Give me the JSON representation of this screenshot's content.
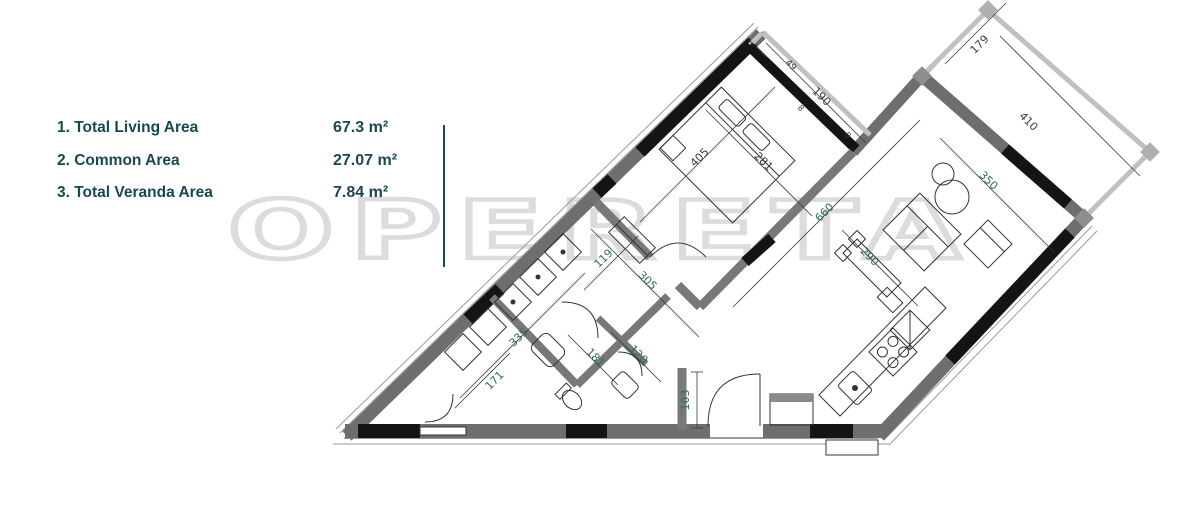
{
  "legend": {
    "items": [
      {
        "label": "1. Total Living Area",
        "value": "67.3 m²"
      },
      {
        "label": "2. Common Area",
        "value": "27.07 m²"
      },
      {
        "label": "3. Total Veranda Area",
        "value": "7.84 m²"
      }
    ]
  },
  "watermark": {
    "text": "OPERETA"
  },
  "colors": {
    "legend_teal": "#17494f",
    "dimension_teal": "#2e6b5e",
    "dimension_dark": "#3c3c3c",
    "wall_gray": "#6e6e6e",
    "wall_black": "#141414",
    "parapet_gray": "#c0c0c0",
    "watermark_gray": "#dcdcdc"
  },
  "floorplan": {
    "dimension_labels": [
      {
        "text": "405",
        "x": 702,
        "y": 160,
        "rot": -45,
        "color": "#3c3c3c"
      },
      {
        "text": "281",
        "x": 761,
        "y": 164,
        "rot": 45,
        "color": "#3c3c3c"
      },
      {
        "text": "190",
        "x": 819,
        "y": 99,
        "rot": 45,
        "color": "#3c3c3c"
      },
      {
        "text": "49",
        "x": 789,
        "y": 67,
        "rot": 45,
        "color": "#3c3c3c",
        "size": 9
      },
      {
        "text": "8",
        "x": 799,
        "y": 110,
        "rot": 45,
        "color": "#3c3c3c",
        "size": 8
      },
      {
        "text": "8",
        "x": 846,
        "y": 137,
        "rot": 45,
        "color": "#3c3c3c",
        "size": 8
      },
      {
        "text": "179",
        "x": 982,
        "y": 47,
        "rot": -45,
        "color": "#3c3c3c"
      },
      {
        "text": "410",
        "x": 1026,
        "y": 124,
        "rot": 45,
        "color": "#3c3c3c"
      },
      {
        "text": "350",
        "x": 986,
        "y": 183,
        "rot": 45,
        "color": "#2e6b5e"
      },
      {
        "text": "660",
        "x": 827,
        "y": 215,
        "rot": -45,
        "color": "#2e6b5e"
      },
      {
        "text": "290",
        "x": 867,
        "y": 259,
        "rot": 45,
        "color": "#2e6b5e"
      },
      {
        "text": "119",
        "x": 606,
        "y": 261,
        "rot": -45,
        "color": "#2e6b5e"
      },
      {
        "text": "305",
        "x": 645,
        "y": 283,
        "rot": 45,
        "color": "#2e6b5e"
      },
      {
        "text": "335",
        "x": 521,
        "y": 340,
        "rot": -45,
        "color": "#2e6b5e"
      },
      {
        "text": "171",
        "x": 497,
        "y": 383,
        "rot": -45,
        "color": "#2e6b5e"
      },
      {
        "text": "181",
        "x": 593,
        "y": 360,
        "rot": 45,
        "color": "#2e6b5e"
      },
      {
        "text": "120",
        "x": 636,
        "y": 357,
        "rot": 45,
        "color": "#2e6b5e"
      },
      {
        "text": "103",
        "x": 689,
        "y": 400,
        "rot": -90,
        "color": "#2e6b5e"
      }
    ]
  }
}
